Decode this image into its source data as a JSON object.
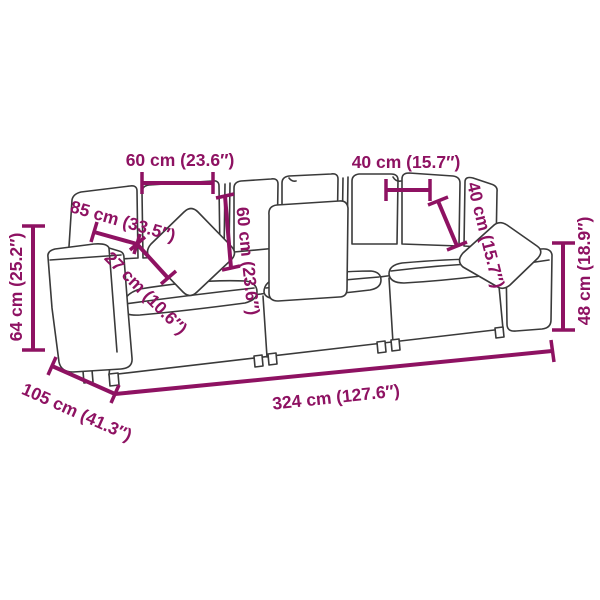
{
  "page": {
    "title": "Sofa dimension diagram",
    "background_color": "#ffffff",
    "illustration": "three-seat modular sofa line drawing with throw pillows",
    "dimension_color": "#8E1262",
    "outline_color": "#3A3A3A"
  },
  "dimensions": [
    {
      "id": "back-cushion-width",
      "label": "60 cm (23.6″)"
    },
    {
      "id": "back-cushion-height",
      "label": "60 cm (23.6″)"
    },
    {
      "id": "right-back-cushion-width",
      "label": "40 cm (15.7″)"
    },
    {
      "id": "right-back-cushion-height",
      "label": "40 cm (15.7″)"
    },
    {
      "id": "seat-depth",
      "label": "85 cm (33.5″)"
    },
    {
      "id": "armrest-width",
      "label": "27 cm (10.6″)"
    },
    {
      "id": "overall-height",
      "label": "64 cm (25.2″)"
    },
    {
      "id": "right-arm-height",
      "label": "48 cm (18.9″)"
    },
    {
      "id": "overall-depth",
      "label": "105 cm (41.3″)"
    },
    {
      "id": "overall-width",
      "label": "324 cm (127.6″)"
    }
  ]
}
